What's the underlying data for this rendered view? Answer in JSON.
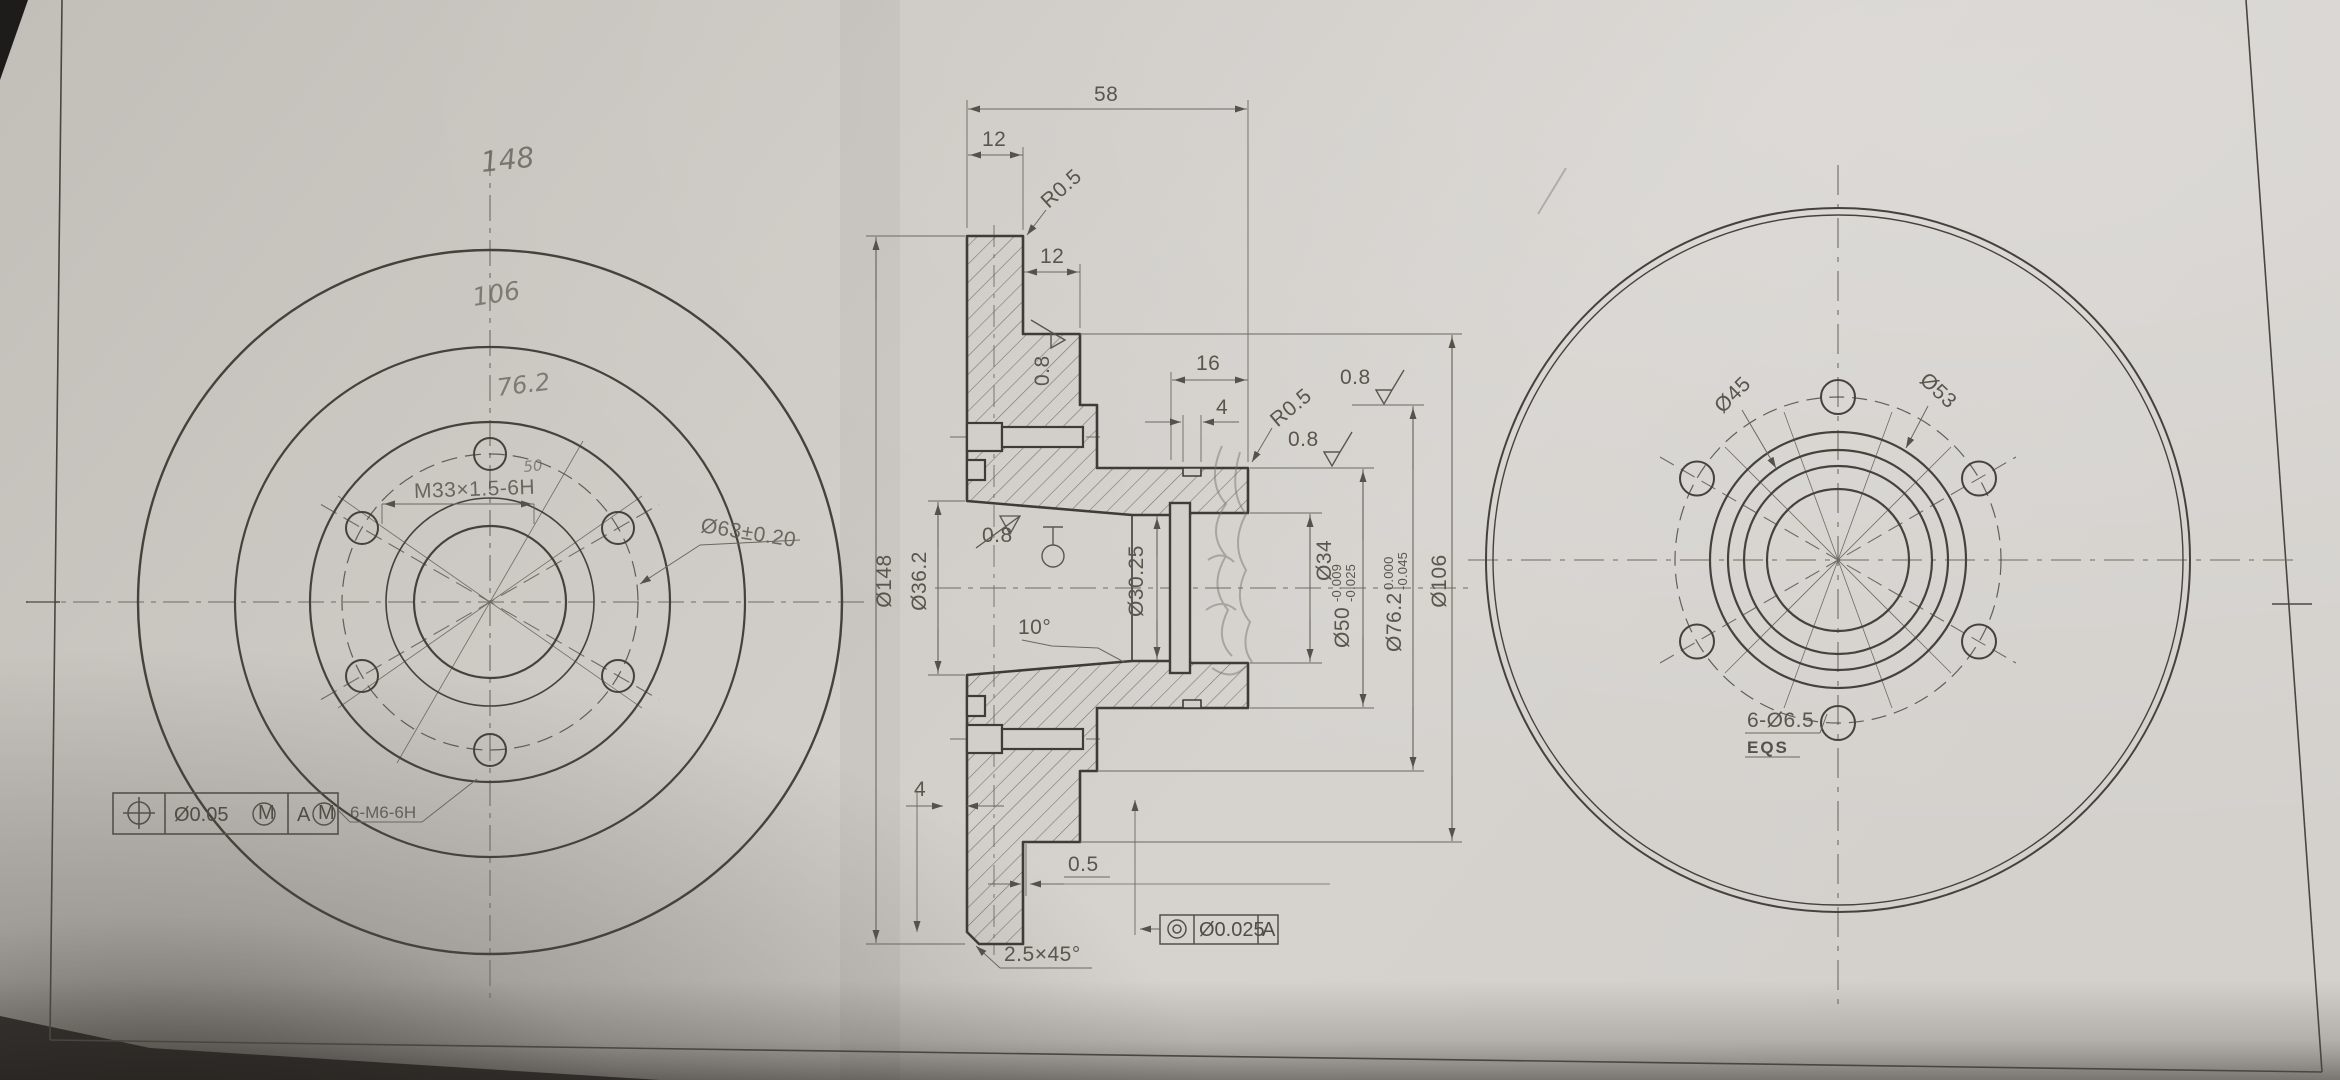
{
  "colors": {
    "paper": "#cfccc7",
    "line": "#44413c",
    "dim_line": "#6b675f",
    "pencil": "#6d675e",
    "table": "#242220"
  },
  "left_view": {
    "hand_dia_outer": "148",
    "hand_dia_mid": "106",
    "hand_dia_bolt": "76.2",
    "hand_note": "50",
    "thread_spec": "M33×1.5-6H",
    "bolt_circle_dia": "Ø63±0.20",
    "fcf": {
      "tolerance": "Ø0.05",
      "modifier_m": "M",
      "datum": "A",
      "leader_note": "6-M6-6H"
    }
  },
  "section_view": {
    "dim_58": "58",
    "dim_12_disc": "12",
    "dim_12_flange": "12",
    "dim_16": "16",
    "dim_4_groove": "4",
    "dim_4_back": "4",
    "dim_05": "0.5",
    "fillet_r05": "R0.5",
    "roughness": "0.8",
    "chamfer": "2.5×45°",
    "taper": "10°",
    "dia_148": "Ø148",
    "dia_36_2": "Ø36.2",
    "dia_30_25": "Ø30.25",
    "dia_34": "Ø34",
    "dia_50": {
      "v": "Ø50",
      "t1": "-0.009",
      "t2": "-0.025"
    },
    "dia_76_2": {
      "v": "Ø76.2",
      "t1": "0.000",
      "t2": "-0.045"
    },
    "dia_106": "Ø106",
    "fcf": {
      "tolerance": "Ø0.025",
      "datum": "A"
    }
  },
  "right_view": {
    "dia_45": "Ø45",
    "dia_53": "Ø53",
    "holes": "6-Ø6.5",
    "holes_note": "EQS"
  }
}
